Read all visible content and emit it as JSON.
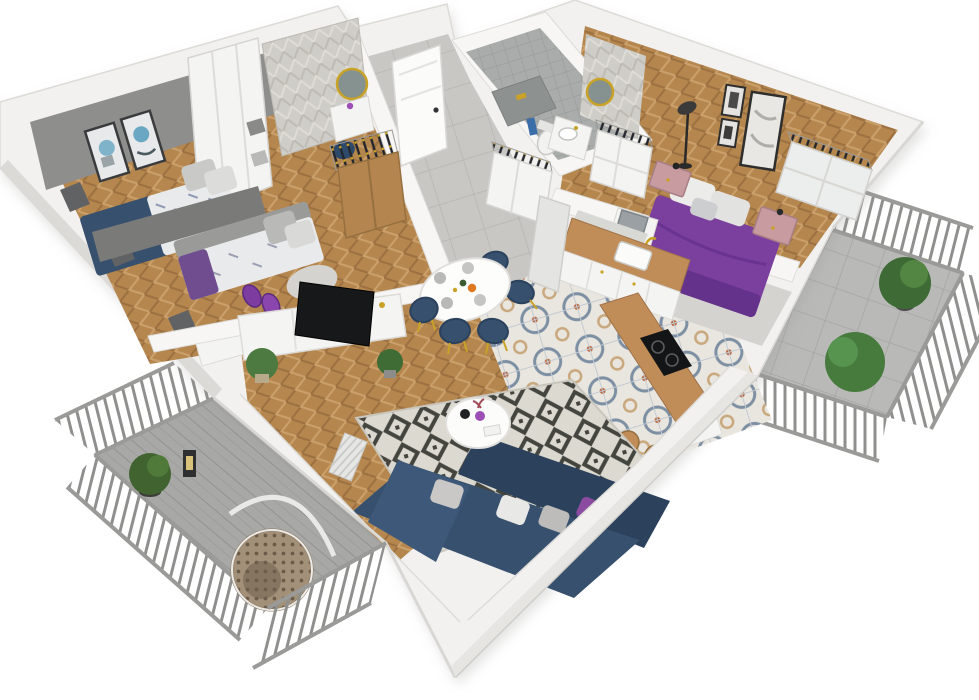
{
  "scene": {
    "title": "apartment-3d-floorplan-render",
    "view": "isometric-cutaway",
    "rooms": [
      {
        "name": "bedroom-small",
        "objects": [
          "gray-accent-wall",
          "two-framed-blue-prints",
          "white-wardrobe",
          "navy-floral-bed",
          "gray-pillows",
          "window"
        ]
      },
      {
        "name": "kids-room",
        "objects": [
          "daybed-gray-frame",
          "floral-bedding",
          "gray-pillows",
          "purple-throw",
          "purple-slipper-chairs",
          "gray-rug",
          "white-desk",
          "window"
        ]
      },
      {
        "name": "entry-hall",
        "objects": [
          "front-door",
          "herringbone-wallpaper",
          "round-gold-mirror",
          "white-console",
          "navy-stool",
          "oak-wardrobe",
          "clothes-rail"
        ]
      },
      {
        "name": "bathroom",
        "objects": [
          "gray-wall-tiles",
          "herringbone-accent-wall",
          "round-gold-mirror",
          "vanity-with-sink",
          "toilet",
          "shower-bench",
          "blue-towel"
        ]
      },
      {
        "name": "master-bedroom",
        "objects": [
          "purple-bed",
          "white-pillows",
          "pink-nightstands",
          "black-floor-lamp",
          "three-bw-art-frames",
          "closet-with-clothes-rail",
          "laptop-desk",
          "gray-rug"
        ]
      },
      {
        "name": "kitchen",
        "objects": [
          "white-cabinets",
          "wood-countertop",
          "sink-gold-faucet",
          "marble-backsplash",
          "tall-fridge-unit",
          "peninsula-wood-counter",
          "induction-hob",
          "bar-stools"
        ]
      },
      {
        "name": "dining-area",
        "objects": [
          "oval-white-table",
          "five-navy-gold-chairs",
          "table-setting",
          "patterned-encaustic-tile-floor"
        ]
      },
      {
        "name": "living-room",
        "objects": [
          "tv-console-white",
          "flat-tv",
          "potted-plants",
          "herringbone-wood-floor",
          "geometric-diamond-rug",
          "round-white-coffee-table",
          "purple-vase",
          "navy-corner-sofa",
          "gray-white-purple-pillows",
          "radiator"
        ]
      },
      {
        "name": "balcony-left",
        "objects": [
          "metal-railing",
          "wood-decking",
          "hanging-egg-chair",
          "potted-plant-on-stand",
          "lantern"
        ]
      },
      {
        "name": "balcony-right",
        "objects": [
          "metal-railing",
          "stone-tile-floor",
          "two-potted-plants"
        ]
      }
    ]
  },
  "palette": {
    "bg": "#ffffff",
    "wall_white": "#f2f1ef",
    "wall_bright": "#f7f6f4",
    "wall_shade": "#e2e1de",
    "wall_dark": "#d8d7d4",
    "gray_wall": "#8e8e8c",
    "gray_wall_dark": "#7a7a78",
    "wood": "#b5874f",
    "oak": "#b5854f",
    "counter_wood": "#c08c58",
    "tile_base": "#e9e6df",
    "corridor": "#c8c7c4",
    "navy": "#36506e",
    "navy_dark": "#2b415c",
    "purple": "#7b3f9e",
    "purple_dark": "#64328a",
    "purple_light": "#9c4fb5",
    "pink": "#c79ba0",
    "rug_base": "#dcd9d0",
    "gray_rug": "#d4d3cf",
    "fence": "#9a9a98",
    "deck_right": "#b9bab8",
    "plant": "#3e6b35",
    "plant_light": "#538543",
    "gold": "#c9a227",
    "tv_black": "#17181a",
    "white_furniture": "#f4f4f2",
    "bath_block": "#8d9190",
    "mirror_glass": "#85928f",
    "towel_blue": "#3a6ea8",
    "lamp_black": "#2a2a2a",
    "fridge": "#e4e5e3",
    "laptop": "#9aa0a4",
    "rattan": "#a39078",
    "marble": "#d8d8d4"
  }
}
